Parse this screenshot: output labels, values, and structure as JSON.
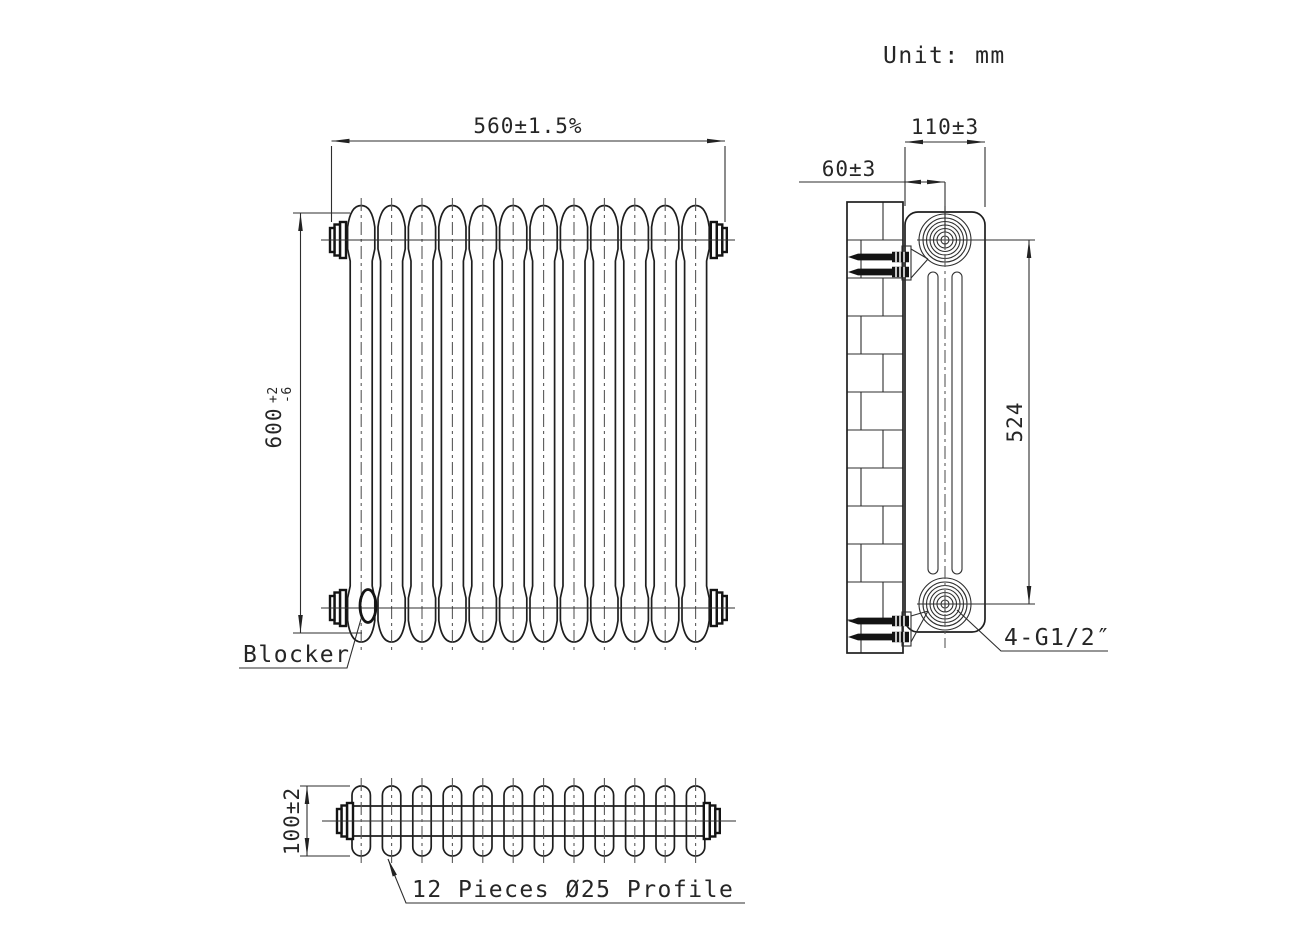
{
  "drawing": {
    "unit_label": "Unit: mm",
    "front_view": {
      "width_dim": "560±1.5%",
      "height_dim_value": "600",
      "height_dim_tol_plus": "+2",
      "height_dim_tol_minus": "-6",
      "blocker_label": "Blocker"
    },
    "side_view": {
      "depth_dim": "110±3",
      "wall_offset_dim": "60±3",
      "pitch_dim": "524",
      "thread_label": "4-G1/2″"
    },
    "top_view": {
      "height_dim": "100±2",
      "profile_label": "12 Pieces Ø25 Profile"
    }
  }
}
